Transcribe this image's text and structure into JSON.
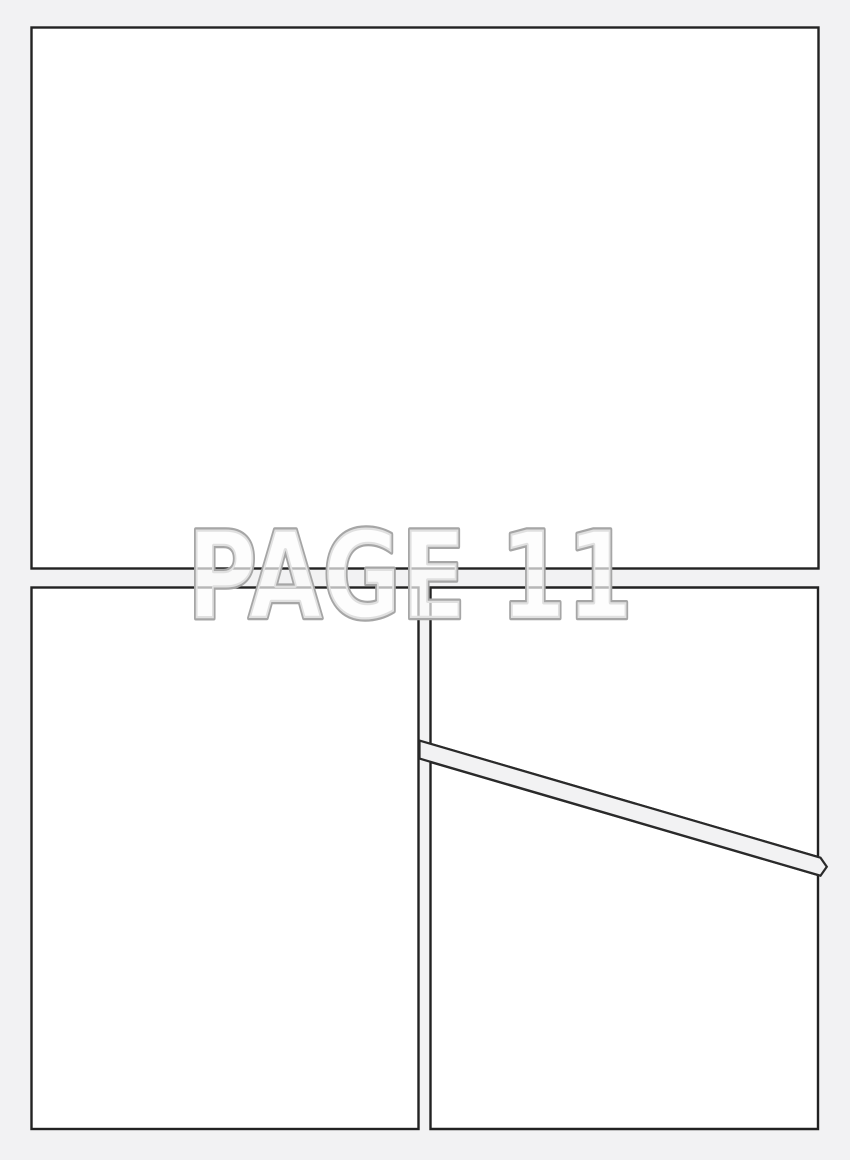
{
  "watermark": {
    "text": "PAGE 11"
  },
  "page": {
    "type": "comic-page-template",
    "panel_count": 4,
    "panels": [
      {
        "name": "top-panel"
      },
      {
        "name": "bottom-left-panel"
      },
      {
        "name": "bottom-right-upper-panel"
      },
      {
        "name": "bottom-right-lower-panel"
      }
    ]
  },
  "colors": {
    "background": "#f2f2f3",
    "panel_fill": "#ffffff",
    "panel_border": "#222222",
    "diagonal_gutter_border": "#2a2a2a",
    "watermark_outline": "#a6a6a6",
    "watermark_fill": "rgba(252,252,252,0.68)"
  }
}
